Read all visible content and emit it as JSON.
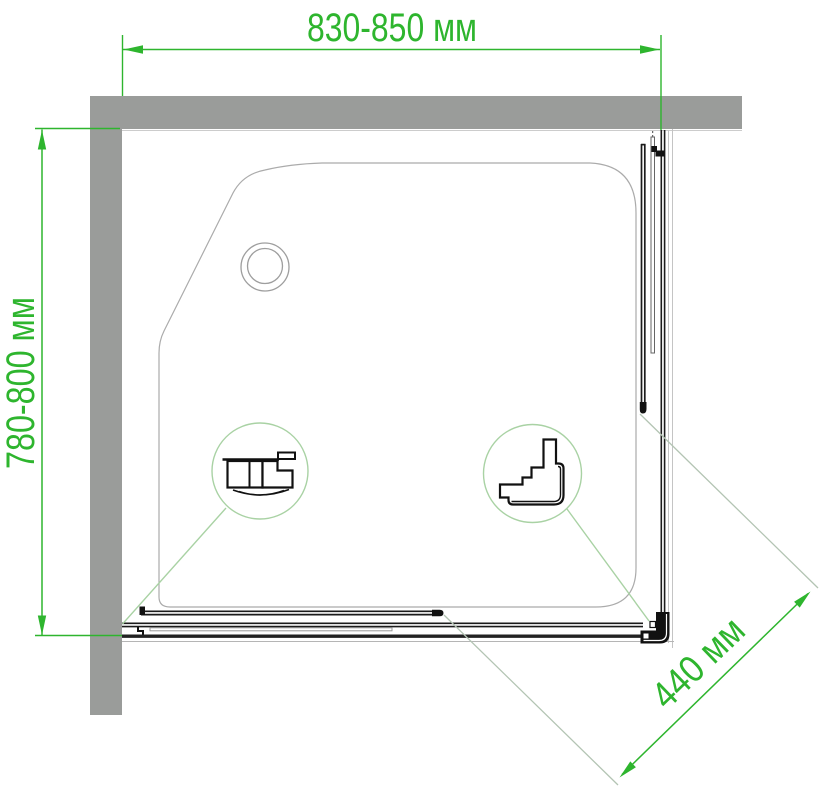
{
  "drawing": {
    "type": "shower-enclosure-top-view",
    "dimensions": {
      "width": {
        "label": "830-850 мм"
      },
      "depth": {
        "label": "780-800 мм"
      },
      "door_opening": {
        "label": "440 мм"
      }
    },
    "callouts": {
      "left": {
        "icon": "wall-mount-profile-section-icon"
      },
      "right": {
        "icon": "corner-connector-profile-section-icon"
      }
    },
    "colors": {
      "dimension_green": "#2eb52e",
      "leader_green": "#a9d2a4",
      "extension_gray_green": "#b3c4b3",
      "wall_gray": "#9a9c9a",
      "tray_outline_gray": "#ababab",
      "profile_dark": "#1b1b1b",
      "background": "#ffffff"
    }
  }
}
